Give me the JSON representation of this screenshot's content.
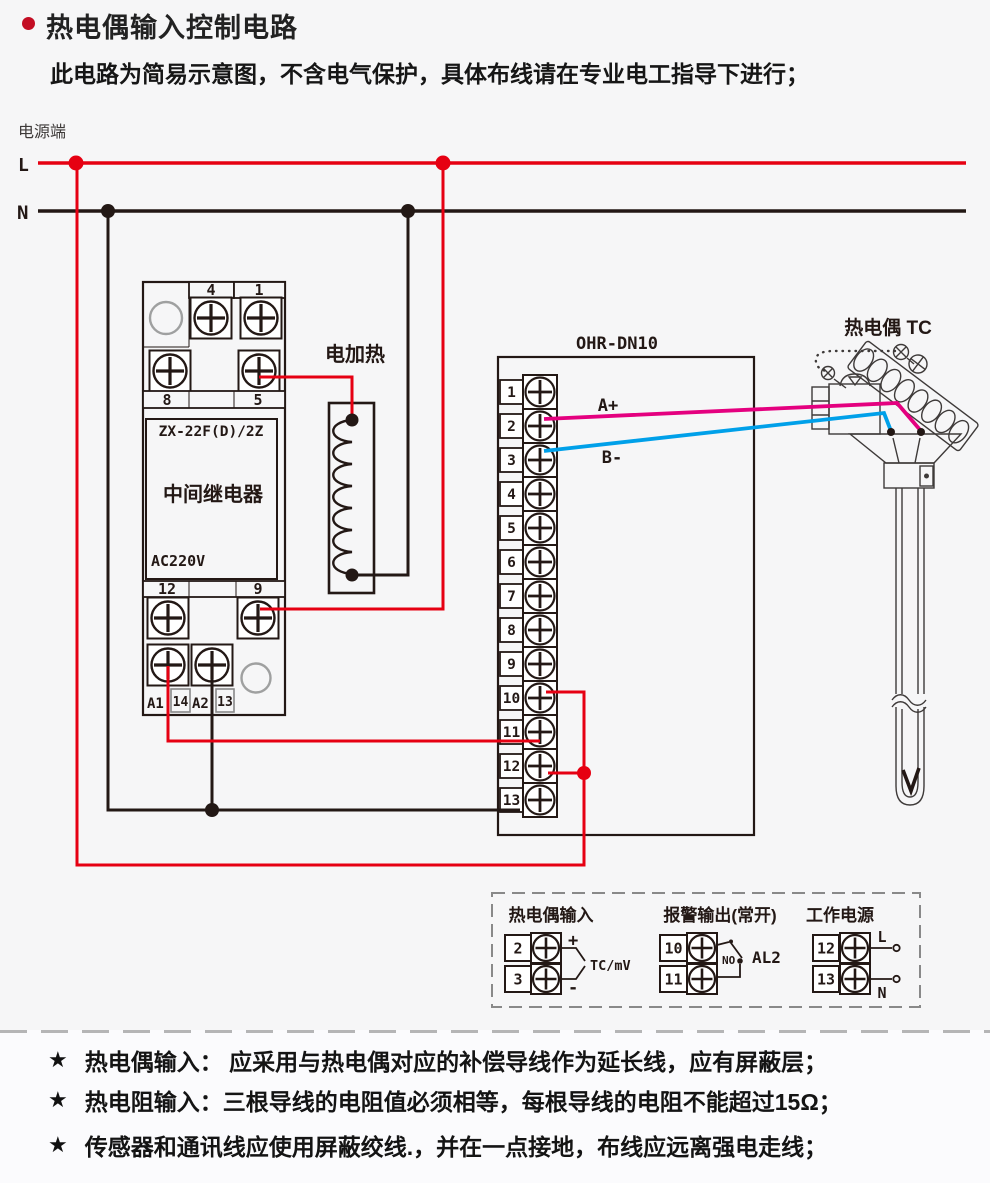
{
  "header": {
    "title": "热电偶输入控制电路",
    "subtitle": "此电路为简易示意图，不含电气保护，具体布线请在专业电工指导下进行；"
  },
  "power": {
    "label": "电源端",
    "line_l": "L",
    "line_n": "N"
  },
  "relay": {
    "model": "ZX-22F(D)/2Z",
    "name": "中间继电器",
    "voltage": "AC220V",
    "t4": "4",
    "t1": "1",
    "t8": "8",
    "t5": "5",
    "t12": "12",
    "t9": "9",
    "a1": "A1",
    "t14": "14",
    "a2": "A2",
    "t13": "13"
  },
  "heater": {
    "label": "电加热"
  },
  "controller": {
    "title": "OHR-DN10",
    "terminals": [
      "1",
      "2",
      "3",
      "4",
      "5",
      "6",
      "7",
      "8",
      "9",
      "10",
      "11",
      "12",
      "13"
    ],
    "a_plus": "A+",
    "b_minus": "B-"
  },
  "thermocouple": {
    "label": "热电偶 TC"
  },
  "legend": {
    "tc_input": {
      "title": "热电偶输入",
      "t_top": "2",
      "t_bottom": "3",
      "plus": "+",
      "minus": "-",
      "signal": "TC/mV"
    },
    "alarm": {
      "title": "报警输出(常开)",
      "t_top": "10",
      "t_bottom": "11",
      "contact": "NO",
      "name": "AL2"
    },
    "supply": {
      "title": "工作电源",
      "t_top": "12",
      "t_bottom": "13",
      "l": "L",
      "n": "N"
    }
  },
  "notes": {
    "star": "★",
    "items": [
      "热电偶输入： 应采用与热电偶对应的补偿导线作为延长线，应有屏蔽层；",
      "热电阻输入：三根导线的电阻值必须相等，每根导线的电阻不能超过15Ω；",
      "传感器和通讯线应使用屏蔽绞线.，并在一点接地，布线应远离强电走线；"
    ]
  },
  "colors": {
    "live": "#e60012",
    "neutral": "#231815",
    "signal_a": "#e4007f",
    "signal_b": "#00a0e9",
    "outline": "#3e3a39"
  }
}
